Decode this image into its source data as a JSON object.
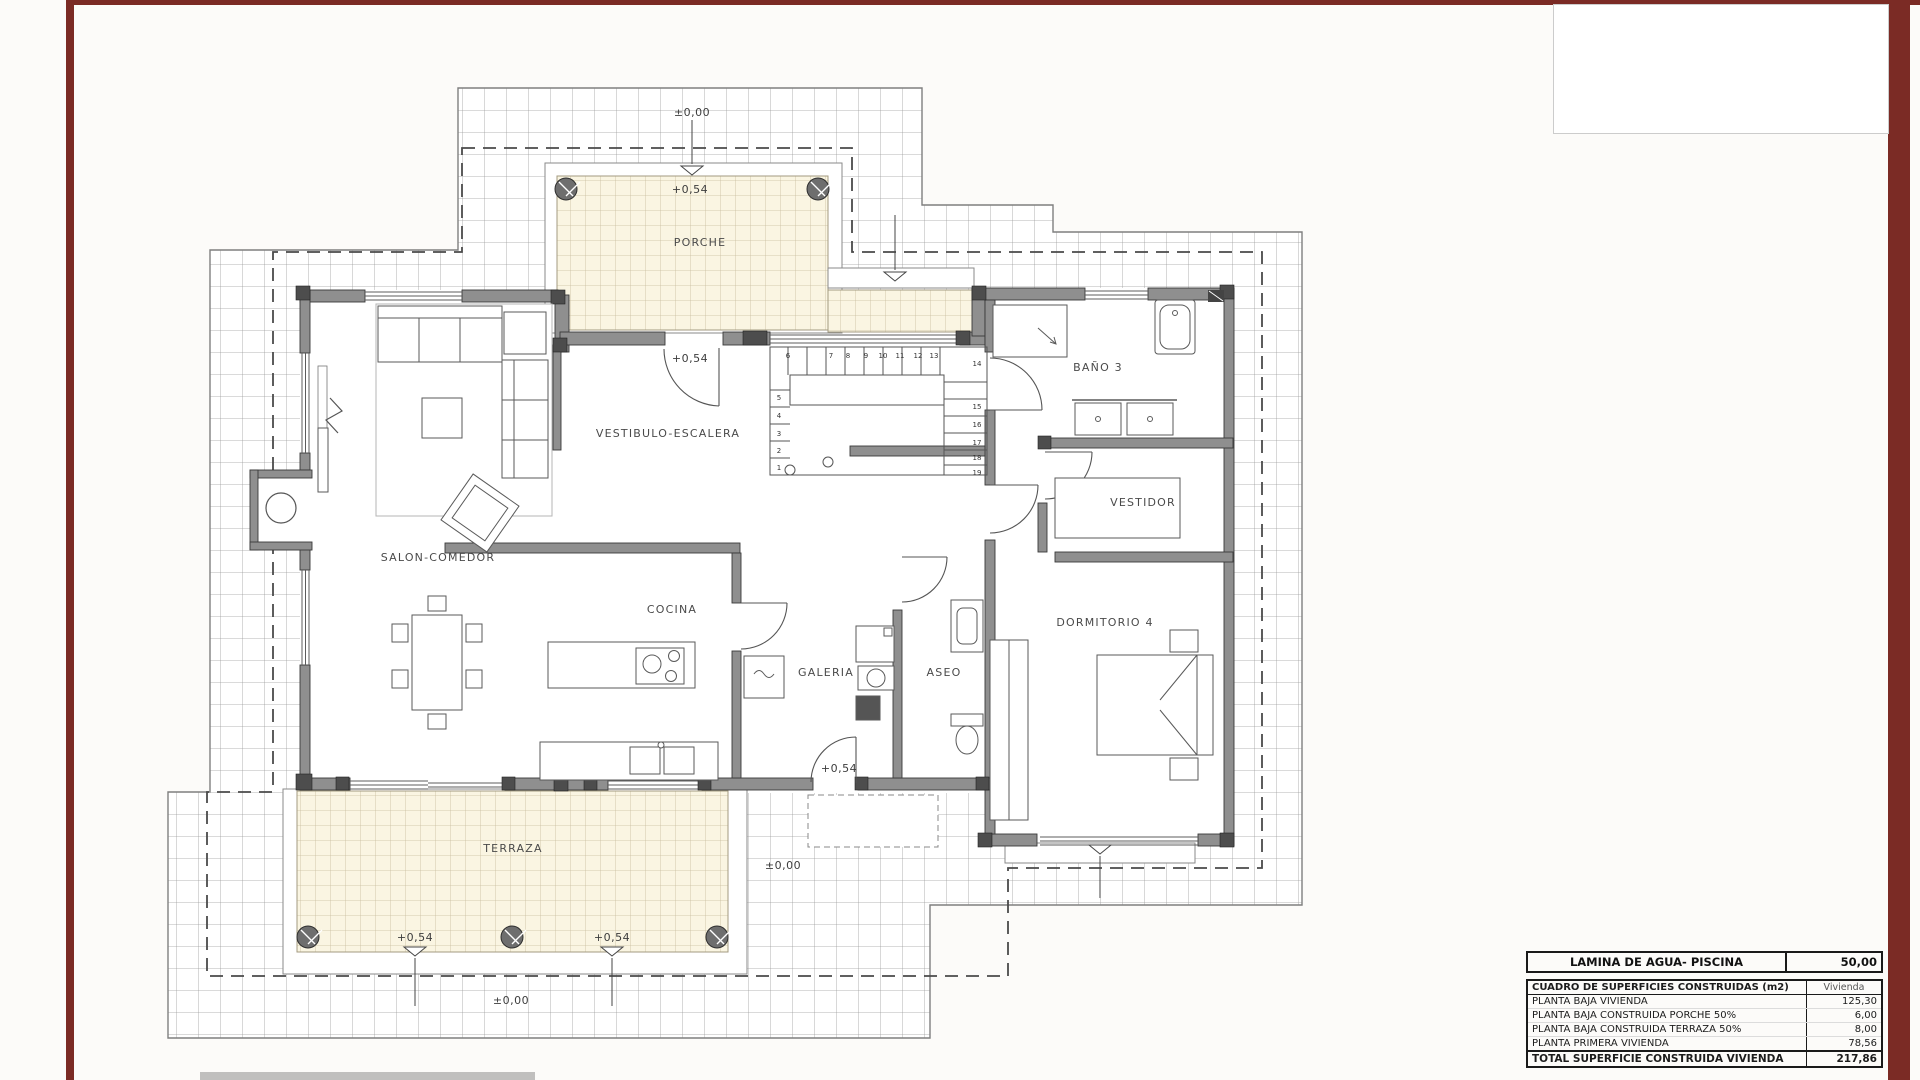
{
  "page": {
    "frame_color": "#7b2b25"
  },
  "plan": {
    "rooms": [
      {
        "id": "porche",
        "label": "PORCHE"
      },
      {
        "id": "vestibulo",
        "label": "VESTIBULO-ESCALERA"
      },
      {
        "id": "salon",
        "label": "SALON-COMEDOR"
      },
      {
        "id": "cocina",
        "label": "COCINA"
      },
      {
        "id": "galeria",
        "label": "GALERIA"
      },
      {
        "id": "aseo",
        "label": "ASEO"
      },
      {
        "id": "bano3",
        "label": "BAÑO 3"
      },
      {
        "id": "vestidor",
        "label": "VESTIDOR"
      },
      {
        "id": "dormitorio4",
        "label": "DORMITORIO 4"
      },
      {
        "id": "terraza",
        "label": "TERRAZA"
      }
    ],
    "levels": {
      "zero": "±0,00",
      "raised": "+0,54"
    },
    "stairs": {
      "numbers": [
        "1",
        "2",
        "3",
        "4",
        "5",
        "6",
        "7",
        "8",
        "9",
        "10",
        "11",
        "12",
        "13",
        "14",
        "15",
        "16",
        "17",
        "18",
        "19"
      ]
    }
  },
  "tables": {
    "pool": {
      "label": "LAMINA DE AGUA- PISCINA",
      "value": "50,00"
    },
    "surfaces": {
      "header": {
        "label": "CUADRO DE SUPERFICIES CONSTRUIDAS (m2)",
        "value": "Vivienda"
      },
      "rows": [
        {
          "label": "PLANTA BAJA VIVIENDA",
          "value": "125,30"
        },
        {
          "label": "PLANTA BAJA CONSTRUIDA PORCHE 50%",
          "value": "6,00"
        },
        {
          "label": "PLANTA BAJA CONSTRUIDA TERRAZA 50%",
          "value": "8,00"
        },
        {
          "label": "PLANTA PRIMERA VIVIENDA",
          "value": "78,56"
        }
      ],
      "total": {
        "label": "TOTAL SUPERFICIE CONSTRUIDA VIVIENDA",
        "value": "217,86"
      }
    }
  }
}
